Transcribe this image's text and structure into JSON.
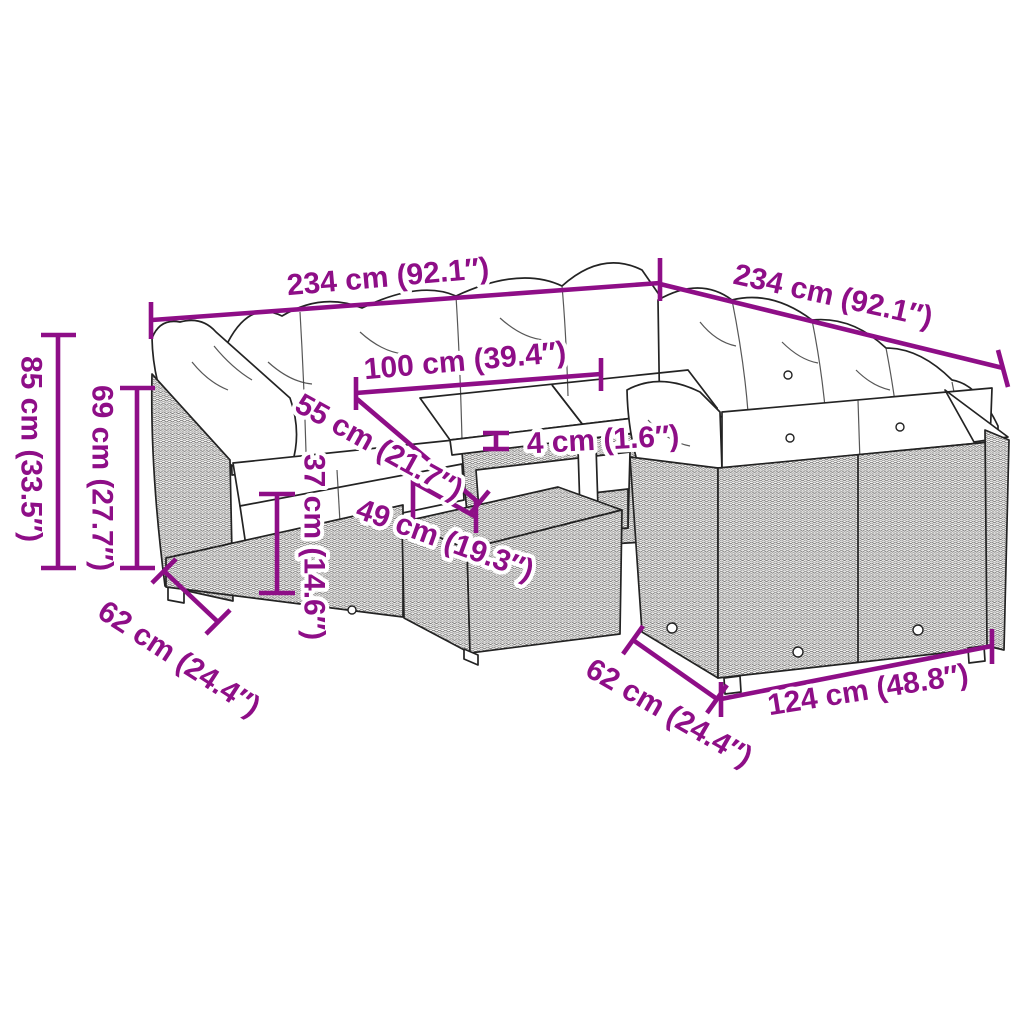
{
  "diagram": {
    "type": "product-dimension-diagram",
    "product": "L-shaped poly rattan garden lounge set with cushions, slatted table and footstool",
    "accent_color": "#8E0E87",
    "background_color": "#FFFFFF",
    "artwork_line_color": "#232323"
  },
  "labels": {
    "dim_width_left": "234 cm (92.1″)",
    "dim_width_right": "234 cm (92.1″)",
    "dim_total_height": "85 cm (33.5″)",
    "dim_back_height": "69 cm (27.7″)",
    "dim_table_length": "100 cm (39.4″)",
    "dim_table_depth": "55 cm (21.7″)",
    "dim_tabletop_thickness": "4 cm (1.6″)",
    "dim_seat_height": "37 cm (14.6″)",
    "dim_stool_width": "49 cm (19.3″)",
    "dim_depth_left": "62 cm (24.4″)",
    "dim_depth_right": "62 cm (24.4″)",
    "dim_bench_length": "124 cm (48.8″)"
  }
}
